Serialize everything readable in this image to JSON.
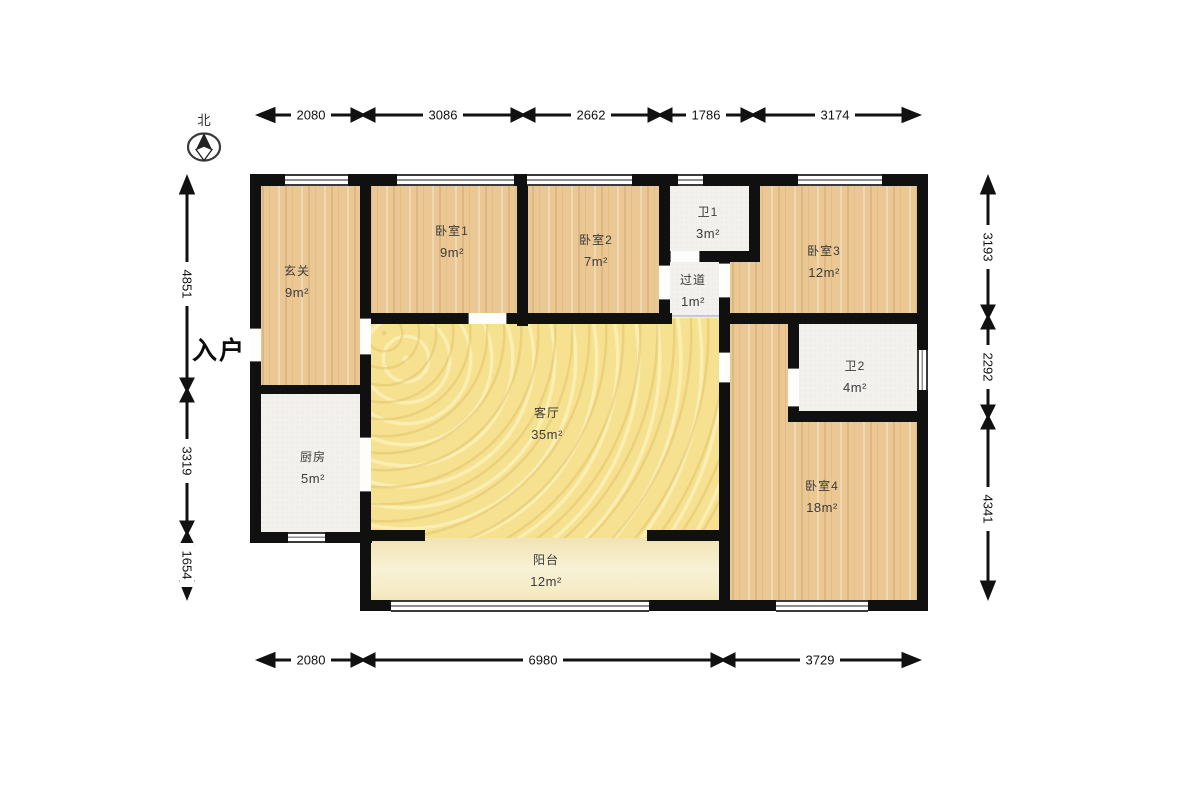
{
  "compass": {
    "label": "北"
  },
  "entrance_label": "入户",
  "rooms": {
    "entry_hall": {
      "name": "玄关",
      "area": "9m²"
    },
    "bedroom1": {
      "name": "卧室1",
      "area": "9m²"
    },
    "bedroom2": {
      "name": "卧室2",
      "area": "7m²"
    },
    "bath1": {
      "name": "卫1",
      "area": "3m²"
    },
    "corridor": {
      "name": "过道",
      "area": "1m²"
    },
    "bedroom3": {
      "name": "卧室3",
      "area": "12m²"
    },
    "kitchen": {
      "name": "厨房",
      "area": "5m²"
    },
    "living": {
      "name": "客厅",
      "area": "35m²"
    },
    "bath2": {
      "name": "卫2",
      "area": "4m²"
    },
    "bedroom4": {
      "name": "卧室4",
      "area": "18m²"
    },
    "balcony": {
      "name": "阳台",
      "area": "12m²"
    }
  },
  "dimensions": {
    "top": [
      "2080",
      "3086",
      "2662",
      "1786",
      "3174"
    ],
    "bottom": [
      "2080",
      "6980",
      "3729"
    ],
    "left": [
      "4851",
      "3319",
      "1654"
    ],
    "right": [
      "3193",
      "2292",
      "4341"
    ]
  },
  "colors": {
    "wall": "#101010",
    "wood_floor": "#eac793",
    "living_floor": "#f6e190",
    "balcony_floor": "#f5ecc8",
    "service_floor": "#f2f1ed"
  }
}
